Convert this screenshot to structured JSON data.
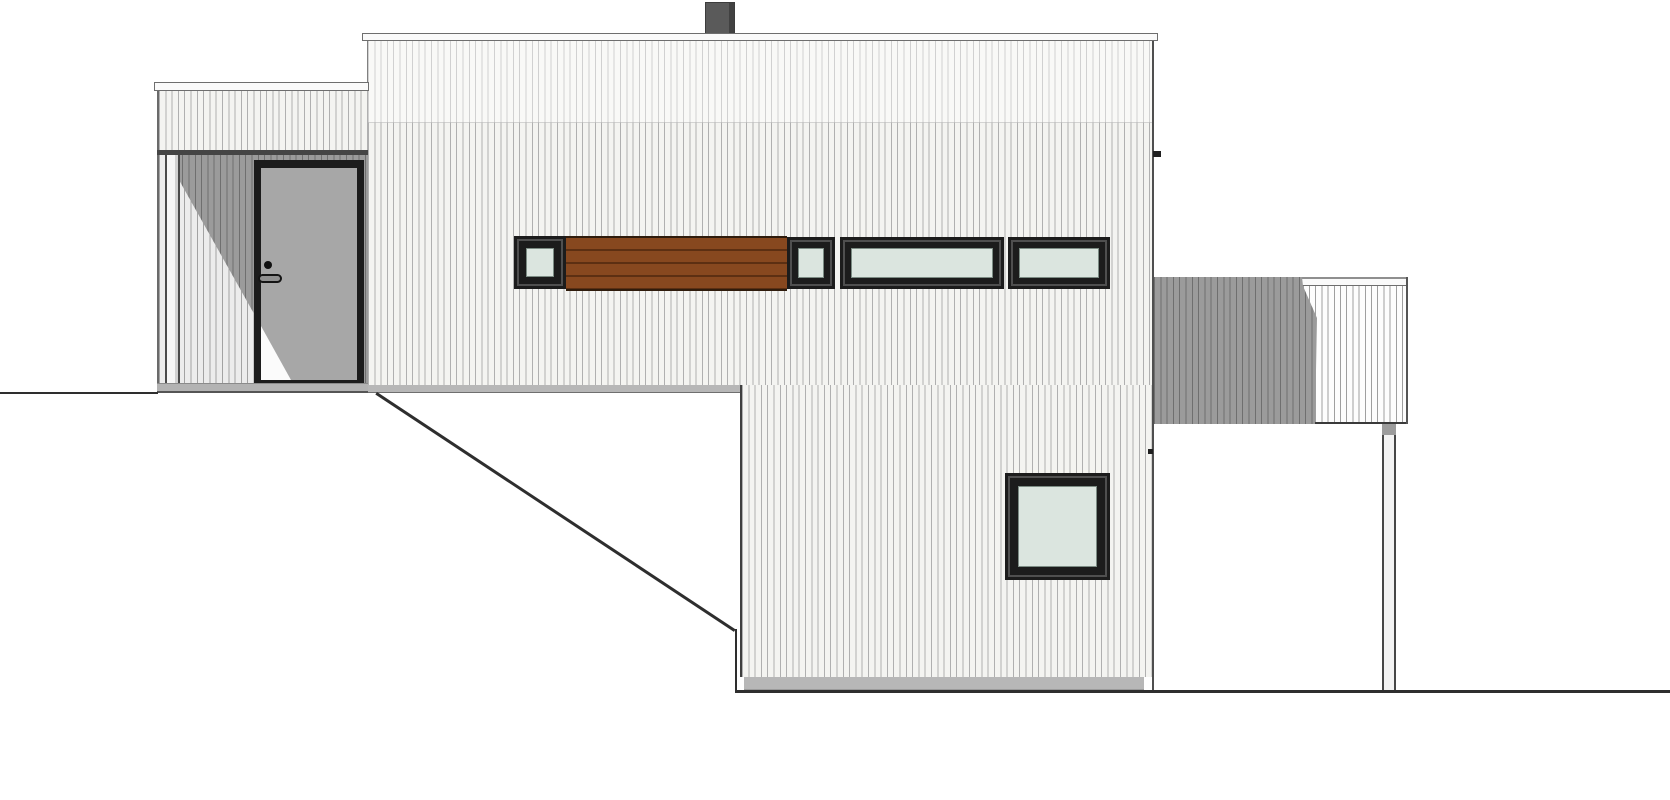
{
  "drawing": {
    "type": "architectural-elevation",
    "view": "side-elevation-of-house",
    "style": "two-volume flat-roof house on sloping terrain, vertical board cladding"
  },
  "colors": {
    "siding_bg": "#f4f4f1",
    "siding_line": "#b0b0b0",
    "shadow_siding_bg": "#9b9b9b",
    "shadow_siding_line": "#6f6f6f",
    "fascia": "#fafafa",
    "frame_dark": "#1c1c1c",
    "glass": "#dbe5df",
    "wood": "#87481f",
    "wood_line": "#5c2f12",
    "door_leaf": "#a7a7a7",
    "chimney": "#5a5a5a",
    "base_strip": "#b7b7b7",
    "ground_line": "#2e2e2e"
  },
  "parts": {
    "chimney": "Chimney",
    "roof_fascia": "Main roof fascia",
    "upper_facade": "Upper floor facade with vertical cladding",
    "lower_facade": "Lower floor facade with vertical cladding",
    "entry_wing": "Entry wing with covered porch",
    "wing_fascia": "Entry wing roof fascia",
    "porch": "Recessed entry porch",
    "porch_post": "Porch corner post",
    "door": "Entrance door",
    "door_handle": "Door handle",
    "door_knob": "Door lock cylinder",
    "clerestory_window_1": "Small square window (window band, left)",
    "wood_panel": "Horizontal wood slat panel",
    "clerestory_window_2": "Small square window (window band, middle)",
    "ribbon_window_1": "Long ribbon window (left)",
    "ribbon_window_2": "Long ribbon window (right)",
    "picture_window": "Square picture window, lower floor",
    "deck_railing": "Terrace railing with vertical slats",
    "deck_post": "Terrace support post",
    "terrain": "Ground / terrain line"
  },
  "counts": {
    "windows_in_band": 4,
    "total_windows": 5,
    "doors": 1
  }
}
